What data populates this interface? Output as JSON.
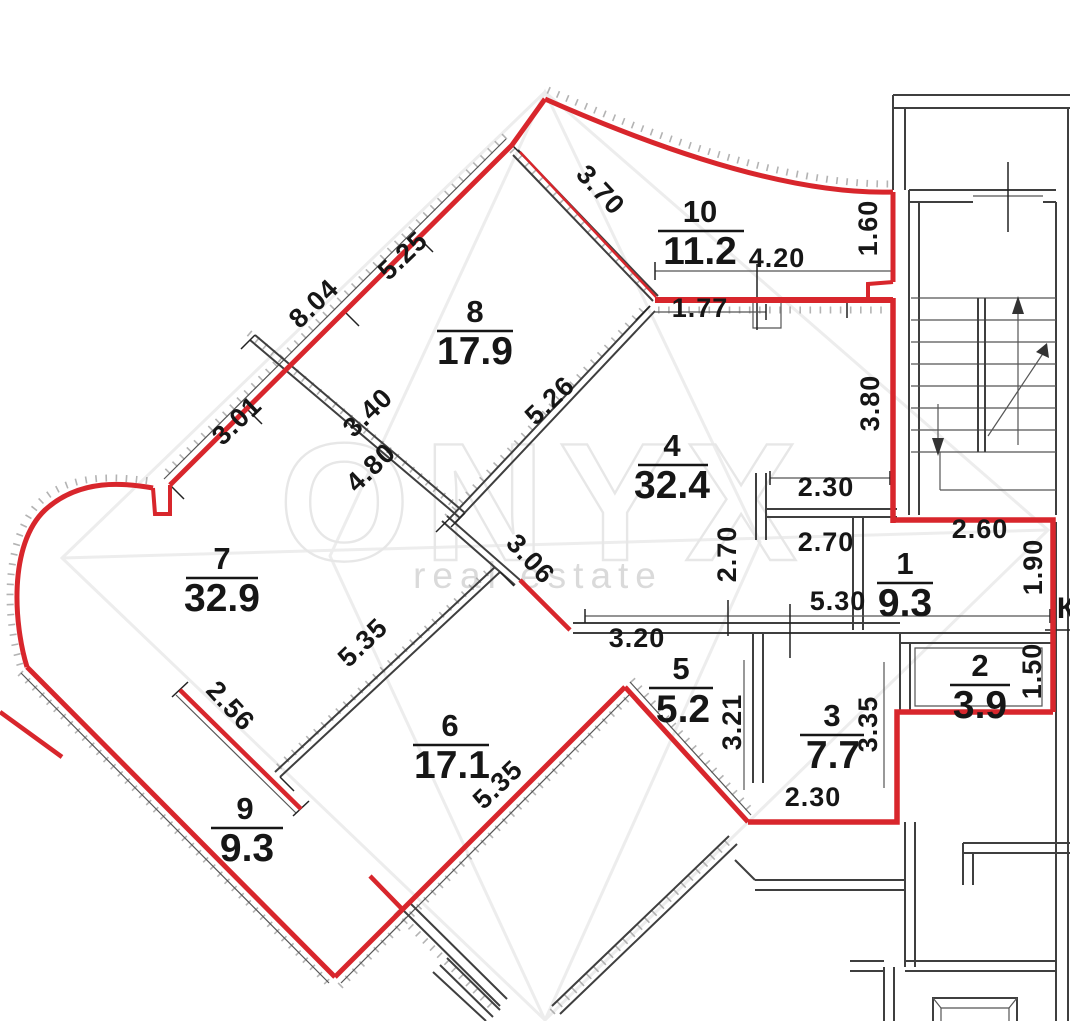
{
  "watermark": {
    "brand": "ONYX",
    "tagline": "real estate"
  },
  "rooms": [
    {
      "num": "10",
      "area": "11.2"
    },
    {
      "num": "8",
      "area": "17.9"
    },
    {
      "num": "4",
      "area": "32.4"
    },
    {
      "num": "7",
      "area": "32.9"
    },
    {
      "num": "1",
      "area": "9.3"
    },
    {
      "num": "2",
      "area": "3.9"
    },
    {
      "num": "5",
      "area": "5.2"
    },
    {
      "num": "3",
      "area": "7.7"
    },
    {
      "num": "6",
      "area": "17.1"
    },
    {
      "num": "9",
      "area": "9.3"
    }
  ],
  "dims": [
    {
      "t": "3.70"
    },
    {
      "t": "5.25"
    },
    {
      "t": "8.04"
    },
    {
      "t": "3.01"
    },
    {
      "t": "3.40"
    },
    {
      "t": "4.80"
    },
    {
      "t": "5.26"
    },
    {
      "t": "3.06"
    },
    {
      "t": "1.60"
    },
    {
      "t": "4.20"
    },
    {
      "t": "1.77"
    },
    {
      "t": "3.80"
    },
    {
      "t": "2.30"
    },
    {
      "t": "2.70"
    },
    {
      "t": "2.70"
    },
    {
      "t": "2.60"
    },
    {
      "t": "1.90"
    },
    {
      "t": "5.30"
    },
    {
      "t": "1.50"
    },
    {
      "t": "3.20"
    },
    {
      "t": "5.35"
    },
    {
      "t": "2.56"
    },
    {
      "t": "5.35"
    },
    {
      "t": "3.21"
    },
    {
      "t": "3.35"
    },
    {
      "t": "2.30"
    }
  ],
  "labels": {
    "shaft": "К"
  },
  "colors": {
    "outline": "#d8262c",
    "walls": "#3f3f3f",
    "watermark": "#e7e7e7"
  }
}
